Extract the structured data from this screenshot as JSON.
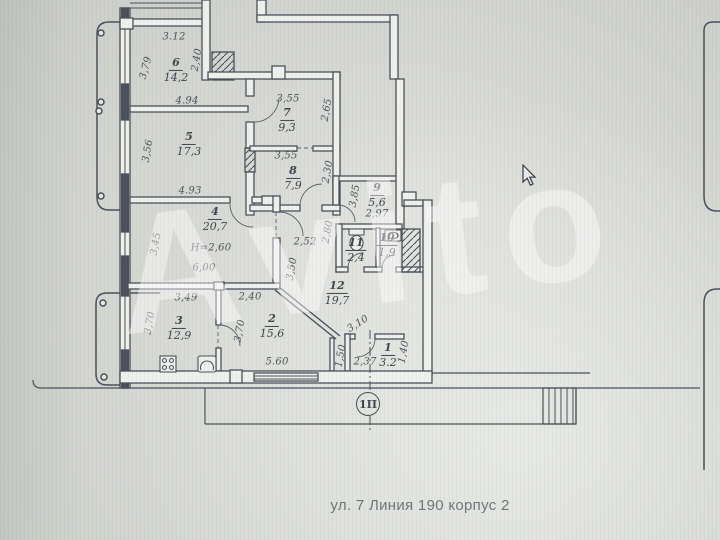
{
  "window": {
    "caption": "ул. 7 Линия 190 корпус 2"
  },
  "watermark": {
    "text": "Avito",
    "color": "#ffffff"
  },
  "plan": {
    "section_mark": "1П",
    "line_color": "#464b55",
    "ceiling_height_note": "H=2,60",
    "rooms": [
      {
        "n": "1",
        "area": "3.2",
        "x": 388,
        "y": 355
      },
      {
        "n": "2",
        "area": "15,6",
        "x": 272,
        "y": 326
      },
      {
        "n": "3",
        "area": "12,9",
        "x": 179,
        "y": 328
      },
      {
        "n": "4",
        "area": "20,7",
        "x": 215,
        "y": 219
      },
      {
        "n": "5",
        "area": "17,3",
        "x": 189,
        "y": 144
      },
      {
        "n": "6",
        "area": "14,2",
        "x": 176,
        "y": 70
      },
      {
        "n": "7",
        "area": "9,3",
        "x": 287,
        "y": 120
      },
      {
        "n": "8",
        "area": "7,9",
        "x": 293,
        "y": 178
      },
      {
        "n": "9",
        "area": "5,6",
        "x": 377,
        "y": 195
      },
      {
        "n": "10",
        "area": "1,9",
        "x": 387,
        "y": 245
      },
      {
        "n": "11",
        "area": "2,4",
        "x": 356,
        "y": 250
      },
      {
        "n": "12",
        "area": "19,7",
        "x": 337,
        "y": 293
      }
    ],
    "dims": [
      {
        "t": "3.12",
        "x": 174,
        "y": 37
      },
      {
        "t": "2,40",
        "x": 197,
        "y": 60,
        "r": -80
      },
      {
        "t": "3,79",
        "x": 146,
        "y": 68,
        "r": -75
      },
      {
        "t": "4.94",
        "x": 187,
        "y": 101
      },
      {
        "t": "3,55",
        "x": 288,
        "y": 99
      },
      {
        "t": "2,65",
        "x": 327,
        "y": 110,
        "r": -80
      },
      {
        "t": "3,56",
        "x": 148,
        "y": 151,
        "r": -80
      },
      {
        "t": "4.93",
        "x": 190,
        "y": 191
      },
      {
        "t": "3,55",
        "x": 286,
        "y": 156
      },
      {
        "t": "2,30",
        "x": 328,
        "y": 172,
        "r": -80
      },
      {
        "t": "3,85",
        "x": 355,
        "y": 196,
        "r": -80
      },
      {
        "t": "2,97",
        "x": 377,
        "y": 214
      },
      {
        "t": "3,45",
        "x": 156,
        "y": 244,
        "r": -80
      },
      {
        "t": "H=2,60",
        "x": 211,
        "y": 248
      },
      {
        "t": "6,00",
        "x": 204,
        "y": 268
      },
      {
        "t": "2,52",
        "x": 305,
        "y": 242
      },
      {
        "t": "2,80",
        "x": 328,
        "y": 232,
        "r": -80
      },
      {
        "t": "3,50",
        "x": 292,
        "y": 269,
        "r": -80
      },
      {
        "t": "3,49",
        "x": 186,
        "y": 298
      },
      {
        "t": "2,40",
        "x": 250,
        "y": 297
      },
      {
        "t": "3,70",
        "x": 150,
        "y": 323,
        "r": -80
      },
      {
        "t": "3,70",
        "x": 240,
        "y": 331,
        "r": -80
      },
      {
        "t": "5.60",
        "x": 277,
        "y": 362
      },
      {
        "t": "3,10",
        "x": 358,
        "y": 324,
        "r": -32
      },
      {
        "t": "1,50",
        "x": 341,
        "y": 356,
        "r": -80
      },
      {
        "t": "2,37",
        "x": 365,
        "y": 362
      },
      {
        "t": "1,40",
        "x": 404,
        "y": 352,
        "r": -80
      }
    ],
    "icons": [
      {
        "name": "toilet-icon",
        "room": "11"
      },
      {
        "name": "washbasin-icon",
        "room": "10"
      },
      {
        "name": "stove-icon",
        "room": "3"
      },
      {
        "name": "kitchen-sink-icon",
        "room": "3"
      }
    ]
  }
}
